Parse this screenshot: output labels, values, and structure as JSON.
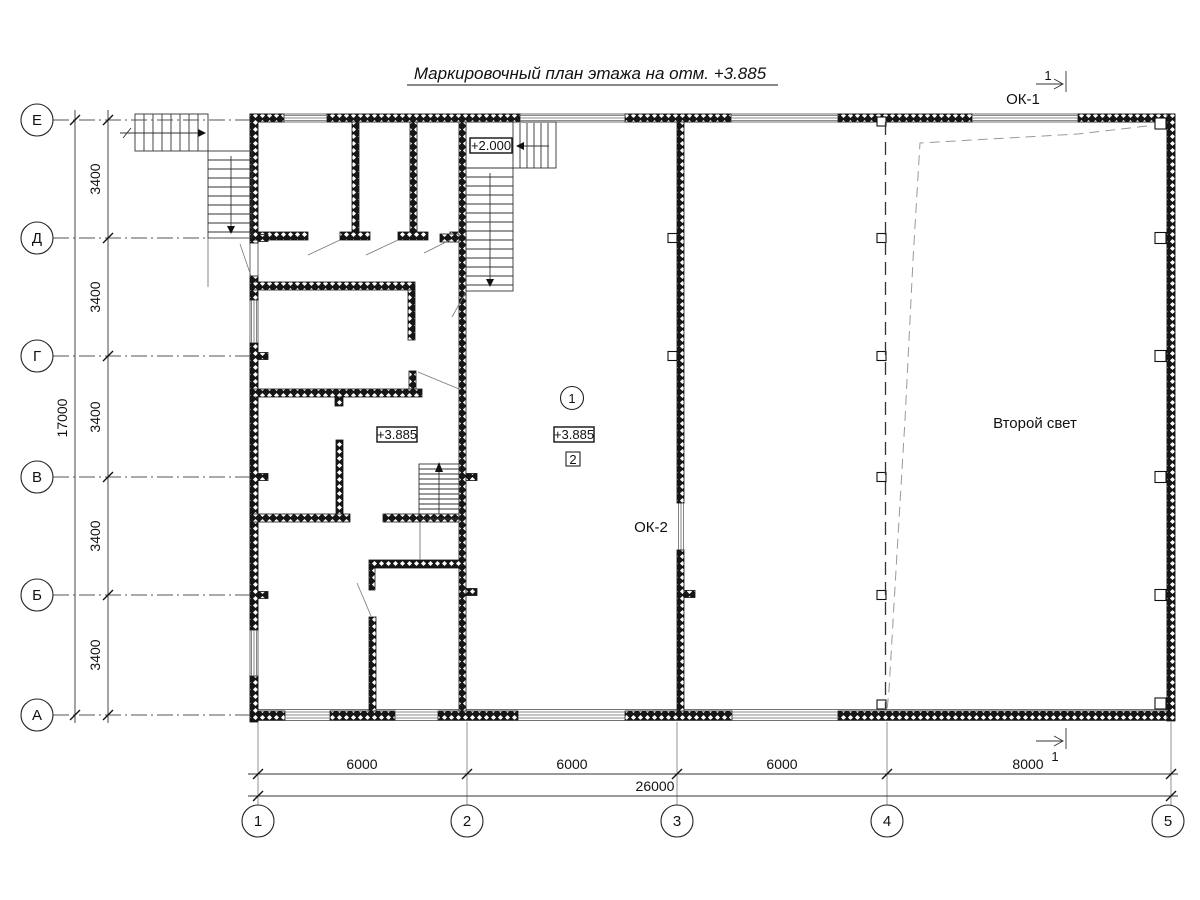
{
  "title": "Маркировочный план этажа на отм. +3.885",
  "axis": {
    "rows": [
      "Е",
      "Д",
      "Г",
      "В",
      "Б",
      "А"
    ],
    "cols": [
      "1",
      "2",
      "3",
      "4",
      "5"
    ]
  },
  "dims": {
    "row_segments": [
      "3400",
      "3400",
      "3400",
      "3400",
      "3400"
    ],
    "row_total": "17000",
    "col_segments": [
      "6000",
      "6000",
      "6000",
      "8000"
    ],
    "col_total": "26000"
  },
  "labels": {
    "ok1": "ОК-1",
    "ok2": "ОК-2",
    "second_light": "Второй свет",
    "elev_left": "+3.885",
    "elev_center": "+3.885",
    "elev_stair": "+2.000",
    "room_marker_circle": "1",
    "room_marker_square": "2",
    "section_top": "1",
    "section_bottom": "1"
  }
}
